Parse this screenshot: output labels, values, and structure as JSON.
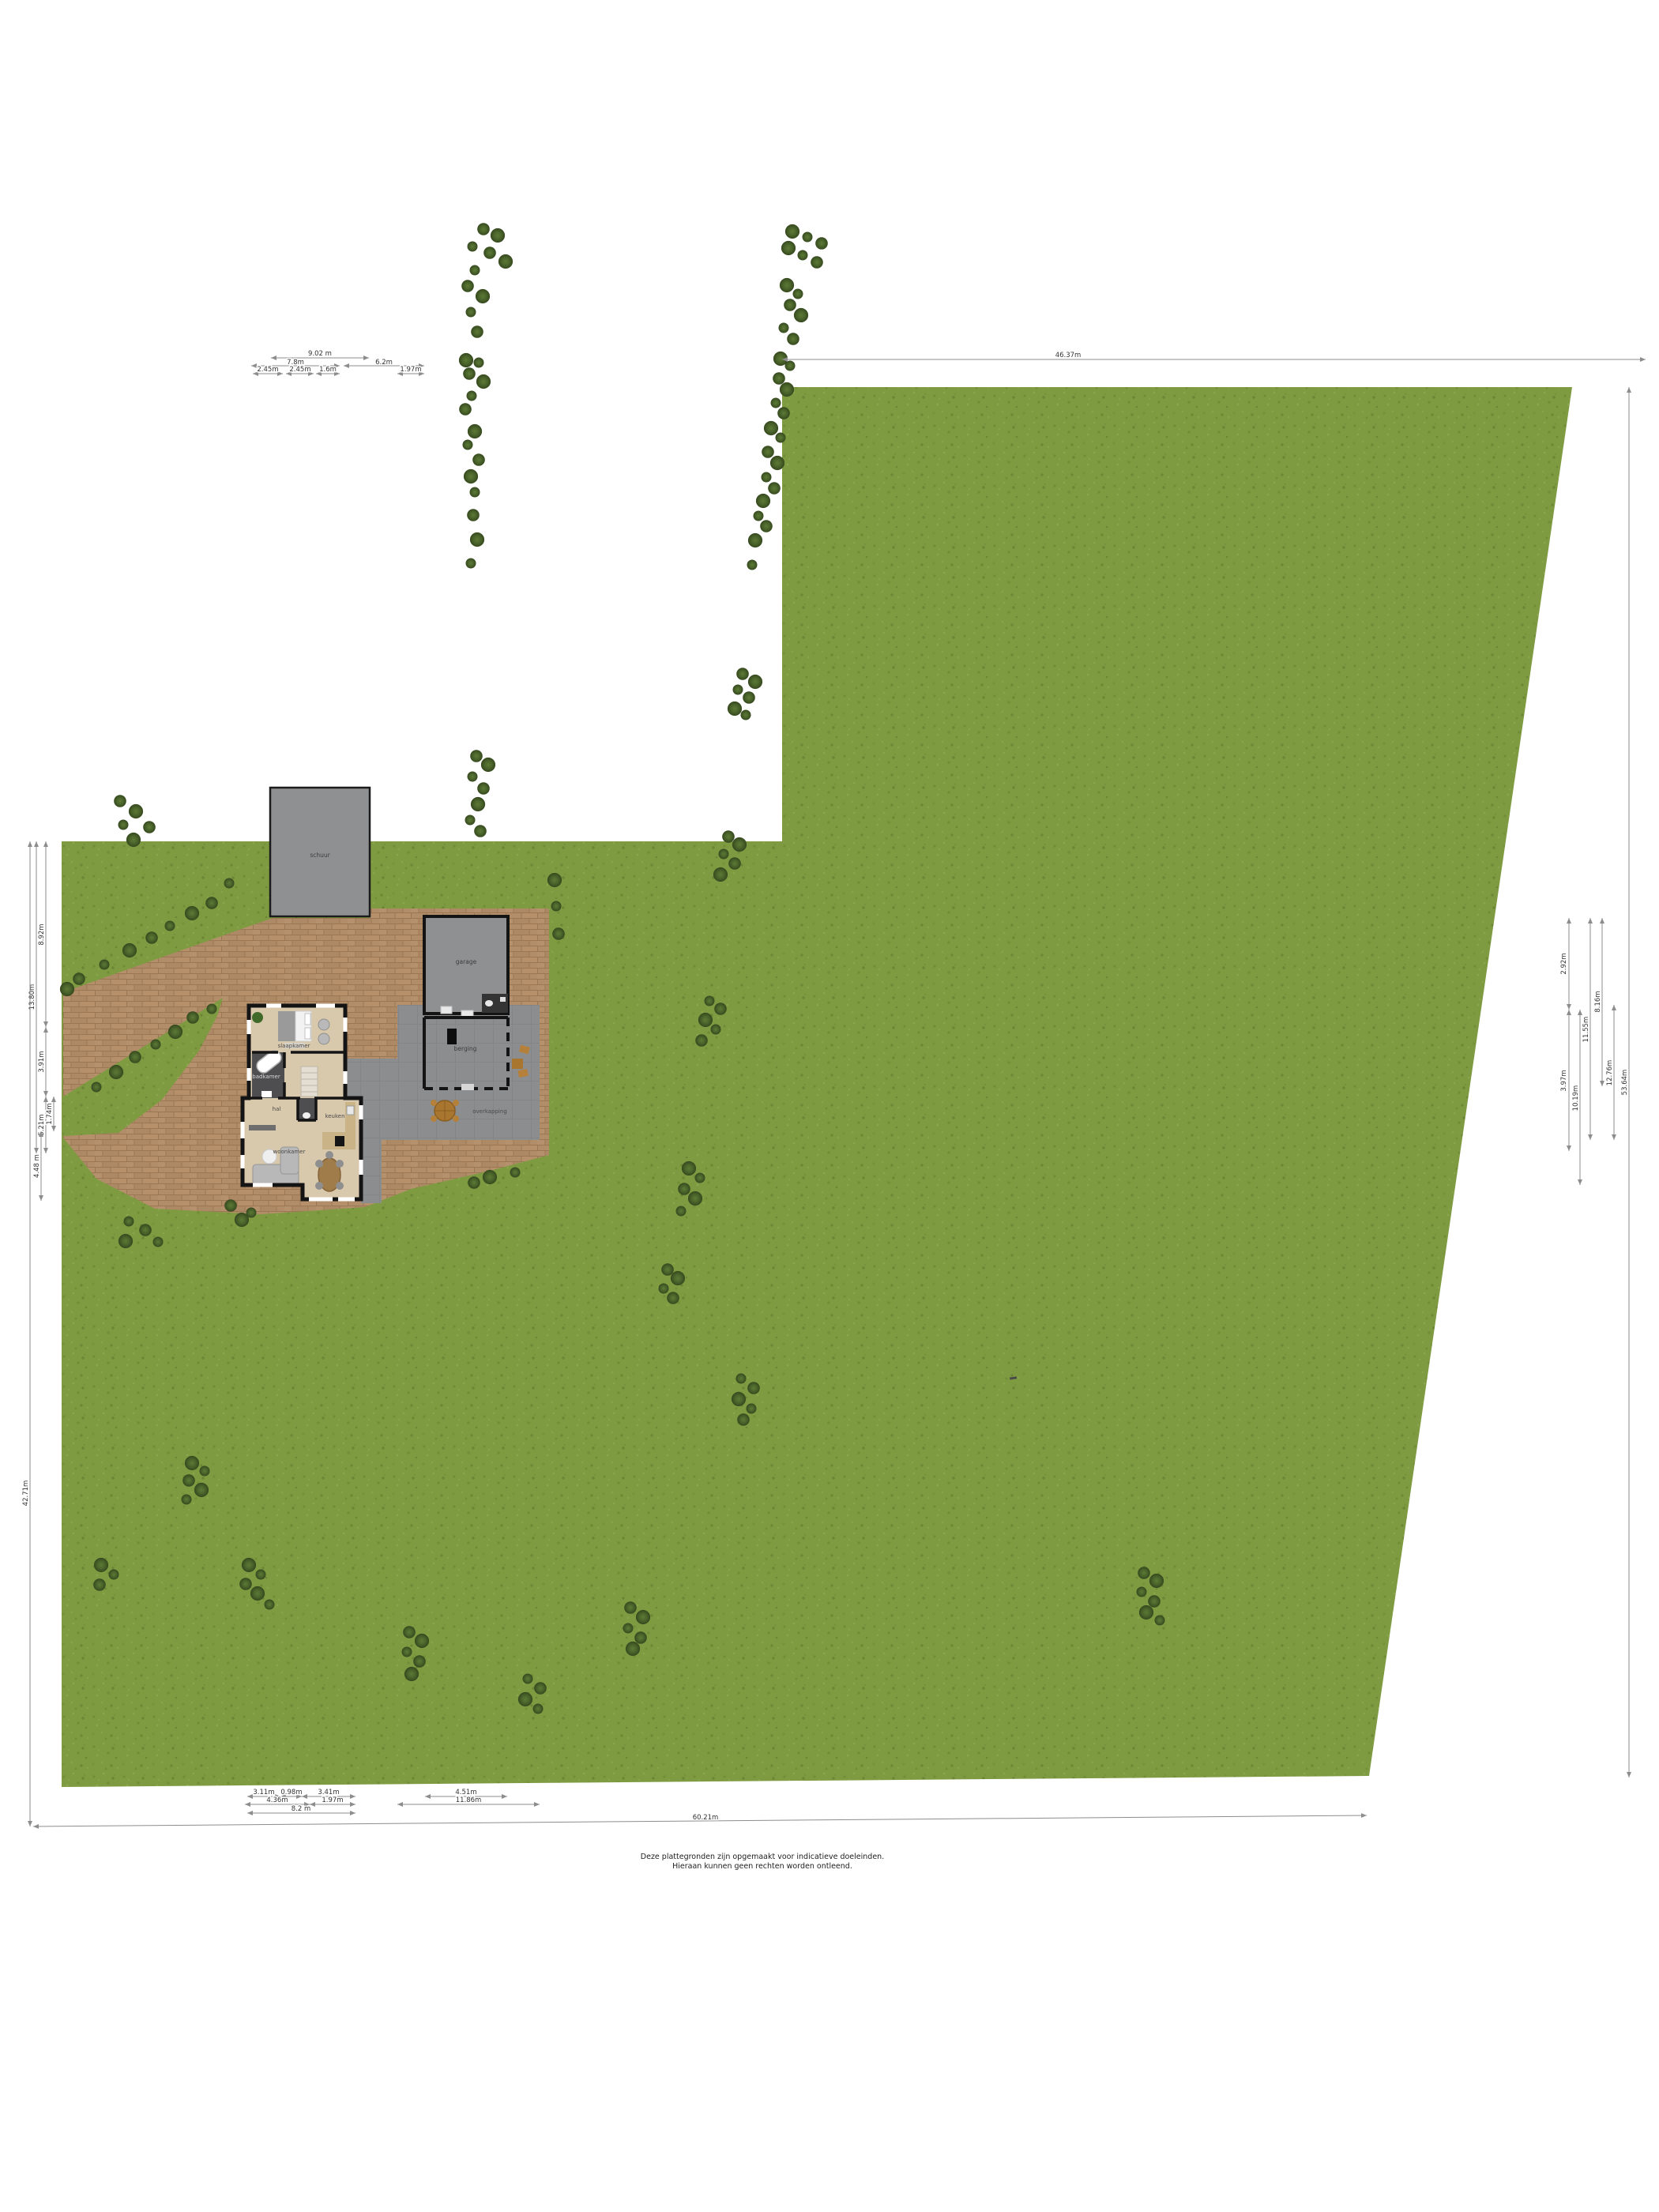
{
  "meta": {
    "kind": "site-plan-floorplan",
    "language": "nl"
  },
  "disclaimer": {
    "line1": "Deze plattegronden zijn opgemaakt voor indicatieve doeleinden.",
    "line2": "Hieraan kunnen geen rechten worden ontleend."
  },
  "labels": {
    "shed": "schuur",
    "garage": "garage",
    "storage": "berging",
    "canopy": "overkapping",
    "bedroom": "slaapkamer",
    "bathroom": "badkamer",
    "hall": "hal",
    "kitchen": "keuken",
    "living": "woonkamer"
  },
  "colors": {
    "grass": "#7e9b41",
    "brick": "#b28d69",
    "terrace": "#8c8d8e",
    "building": "#8f9092",
    "wall": "#141414",
    "floor": "#d9c9ac",
    "floor_dark": "#4e4e50",
    "tree": "#49632a",
    "dim_line": "#8d8d8d"
  },
  "dims": [
    [
      343,
      453,
      467,
      453,
      "9.02 m",
      405,
      450,
      0
    ],
    [
      318,
      463,
      430,
      463,
      "7.8m",
      374,
      461,
      0
    ],
    [
      435,
      463,
      537,
      463,
      "6.2m",
      486,
      461,
      0
    ],
    [
      320,
      473,
      358,
      473,
      "2.45m",
      339,
      470,
      0
    ],
    [
      362,
      473,
      397,
      473,
      "2.45m",
      380,
      470,
      0
    ],
    [
      400,
      473,
      430,
      473,
      "1.6m",
      415,
      470,
      0
    ],
    [
      503,
      473,
      537,
      473,
      "1.97m",
      520,
      470,
      0
    ],
    [
      990,
      455,
      2083,
      455,
      "46.37m",
      1352,
      452,
      0
    ],
    [
      1986,
      1162,
      1986,
      1278,
      "2.92m",
      1982,
      1220,
      -90
    ],
    [
      1986,
      1278,
      1986,
      1457,
      "3.97m",
      1982,
      1368,
      -90
    ],
    [
      2000,
      1278,
      2000,
      1500,
      "10.19m",
      1997,
      1390,
      -90
    ],
    [
      2013,
      1162,
      2013,
      1443,
      "11.55m",
      2010,
      1303,
      -90
    ],
    [
      2028,
      1162,
      2028,
      1375,
      "8.16m",
      2025,
      1268,
      -90
    ],
    [
      2043,
      1272,
      2043,
      1443,
      "12.76m",
      2040,
      1358,
      -90
    ],
    [
      2062,
      490,
      2062,
      2250,
      "53.64m",
      2059,
      1370,
      -90
    ],
    [
      58,
      1065,
      58,
      1300,
      "8.92m",
      55,
      1183,
      -90
    ],
    [
      58,
      1300,
      58,
      1388,
      "3.91m",
      55,
      1344,
      -90
    ],
    [
      58,
      1388,
      58,
      1460,
      "5.21m",
      55,
      1424,
      -90
    ],
    [
      68,
      1388,
      68,
      1432,
      "1.74m",
      65,
      1410,
      -90
    ],
    [
      46,
      1065,
      46,
      1460,
      "13.80m",
      43,
      1262,
      -90
    ],
    [
      52,
      1432,
      52,
      1520,
      "4.48 m",
      49,
      1476,
      -90
    ],
    [
      38,
      1065,
      38,
      2312,
      "42.71m",
      35,
      1890,
      -90
    ],
    [
      313,
      2274,
      355,
      2274,
      "3.11m",
      334,
      2271,
      0
    ],
    [
      355,
      2274,
      382,
      2274,
      "0.98m",
      369,
      2271,
      0
    ],
    [
      382,
      2274,
      450,
      2274,
      "3.41m",
      416,
      2271,
      0
    ],
    [
      310,
      2284,
      392,
      2284,
      "4.36m",
      351,
      2281,
      0
    ],
    [
      392,
      2284,
      450,
      2284,
      "1.97m",
      421,
      2281,
      0
    ],
    [
      313,
      2295,
      450,
      2295,
      "8.2 m",
      381,
      2292,
      0
    ],
    [
      538,
      2274,
      642,
      2274,
      "4.51m",
      590,
      2271,
      0
    ],
    [
      503,
      2284,
      683,
      2284,
      "11.86m",
      593,
      2281,
      0
    ],
    [
      42,
      2312,
      1730,
      2298,
      "60.21m",
      893,
      2303,
      0
    ]
  ],
  "trees": [
    [
      290,
      1118
    ],
    [
      268,
      1143
    ],
    [
      243,
      1156
    ],
    [
      215,
      1172
    ],
    [
      192,
      1187
    ],
    [
      164,
      1203
    ],
    [
      132,
      1221
    ],
    [
      100,
      1239
    ],
    [
      85,
      1252
    ],
    [
      268,
      1277
    ],
    [
      244,
      1288
    ],
    [
      222,
      1306
    ],
    [
      197,
      1322
    ],
    [
      171,
      1338
    ],
    [
      147,
      1357
    ],
    [
      122,
      1376
    ],
    [
      152,
      1014
    ],
    [
      172,
      1027
    ],
    [
      156,
      1044
    ],
    [
      189,
      1047
    ],
    [
      169,
      1063
    ],
    [
      163,
      1546
    ],
    [
      184,
      1557
    ],
    [
      159,
      1571
    ],
    [
      200,
      1572
    ],
    [
      292,
      1526
    ],
    [
      306,
      1544
    ],
    [
      318,
      1535
    ],
    [
      612,
      290
    ],
    [
      630,
      298
    ],
    [
      598,
      312
    ],
    [
      620,
      320
    ],
    [
      640,
      331
    ],
    [
      601,
      342
    ],
    [
      592,
      362
    ],
    [
      611,
      375
    ],
    [
      596,
      395
    ],
    [
      604,
      420
    ],
    [
      590,
      456
    ],
    [
      606,
      459
    ],
    [
      594,
      473
    ],
    [
      612,
      483
    ],
    [
      597,
      501
    ],
    [
      589,
      518
    ],
    [
      601,
      546
    ],
    [
      592,
      563
    ],
    [
      606,
      582
    ],
    [
      596,
      603
    ],
    [
      601,
      623
    ],
    [
      599,
      652
    ],
    [
      604,
      683
    ],
    [
      596,
      713
    ],
    [
      603,
      957
    ],
    [
      618,
      968
    ],
    [
      598,
      983
    ],
    [
      612,
      998
    ],
    [
      605,
      1018
    ],
    [
      595,
      1038
    ],
    [
      608,
      1052
    ],
    [
      702,
      1114
    ],
    [
      704,
      1147
    ],
    [
      707,
      1182
    ],
    [
      620,
      1490
    ],
    [
      652,
      1484
    ],
    [
      600,
      1497
    ],
    [
      1003,
      293
    ],
    [
      1022,
      300
    ],
    [
      1040,
      308
    ],
    [
      998,
      314
    ],
    [
      1016,
      323
    ],
    [
      1034,
      332
    ],
    [
      996,
      361
    ],
    [
      1010,
      372
    ],
    [
      1000,
      386
    ],
    [
      1014,
      399
    ],
    [
      992,
      415
    ],
    [
      1004,
      429
    ],
    [
      988,
      454
    ],
    [
      1000,
      463
    ],
    [
      986,
      479
    ],
    [
      996,
      493
    ],
    [
      982,
      510
    ],
    [
      992,
      523
    ],
    [
      976,
      542
    ],
    [
      988,
      554
    ],
    [
      972,
      572
    ],
    [
      984,
      586
    ],
    [
      970,
      604
    ],
    [
      980,
      618
    ],
    [
      966,
      634
    ],
    [
      960,
      653
    ],
    [
      970,
      666
    ],
    [
      956,
      684
    ],
    [
      952,
      715
    ],
    [
      940,
      853
    ],
    [
      956,
      863
    ],
    [
      934,
      873
    ],
    [
      948,
      883
    ],
    [
      930,
      897
    ],
    [
      944,
      905
    ],
    [
      922,
      1059
    ],
    [
      936,
      1069
    ],
    [
      916,
      1081
    ],
    [
      930,
      1093
    ],
    [
      912,
      1107
    ],
    [
      898,
      1267
    ],
    [
      912,
      1277
    ],
    [
      893,
      1291
    ],
    [
      906,
      1303
    ],
    [
      888,
      1317
    ],
    [
      872,
      1479
    ],
    [
      886,
      1491
    ],
    [
      866,
      1505
    ],
    [
      880,
      1517
    ],
    [
      862,
      1533
    ],
    [
      845,
      1607
    ],
    [
      858,
      1618
    ],
    [
      840,
      1631
    ],
    [
      852,
      1643
    ],
    [
      128,
      1981
    ],
    [
      144,
      1993
    ],
    [
      126,
      2006
    ],
    [
      315,
      1981
    ],
    [
      330,
      1993
    ],
    [
      311,
      2005
    ],
    [
      326,
      2017
    ],
    [
      341,
      2031
    ],
    [
      518,
      2066
    ],
    [
      534,
      2077
    ],
    [
      515,
      2091
    ],
    [
      531,
      2103
    ],
    [
      521,
      2119
    ],
    [
      668,
      2125
    ],
    [
      684,
      2137
    ],
    [
      665,
      2151
    ],
    [
      681,
      2163
    ],
    [
      798,
      2035
    ],
    [
      814,
      2047
    ],
    [
      795,
      2061
    ],
    [
      811,
      2073
    ],
    [
      801,
      2087
    ],
    [
      938,
      1745
    ],
    [
      954,
      1757
    ],
    [
      935,
      1771
    ],
    [
      951,
      1783
    ],
    [
      941,
      1797
    ],
    [
      243,
      1852
    ],
    [
      259,
      1862
    ],
    [
      239,
      1874
    ],
    [
      255,
      1886
    ],
    [
      236,
      1898
    ],
    [
      1448,
      1991
    ],
    [
      1464,
      2001
    ],
    [
      1445,
      2015
    ],
    [
      1461,
      2027
    ],
    [
      1451,
      2041
    ],
    [
      1468,
      2051
    ]
  ]
}
